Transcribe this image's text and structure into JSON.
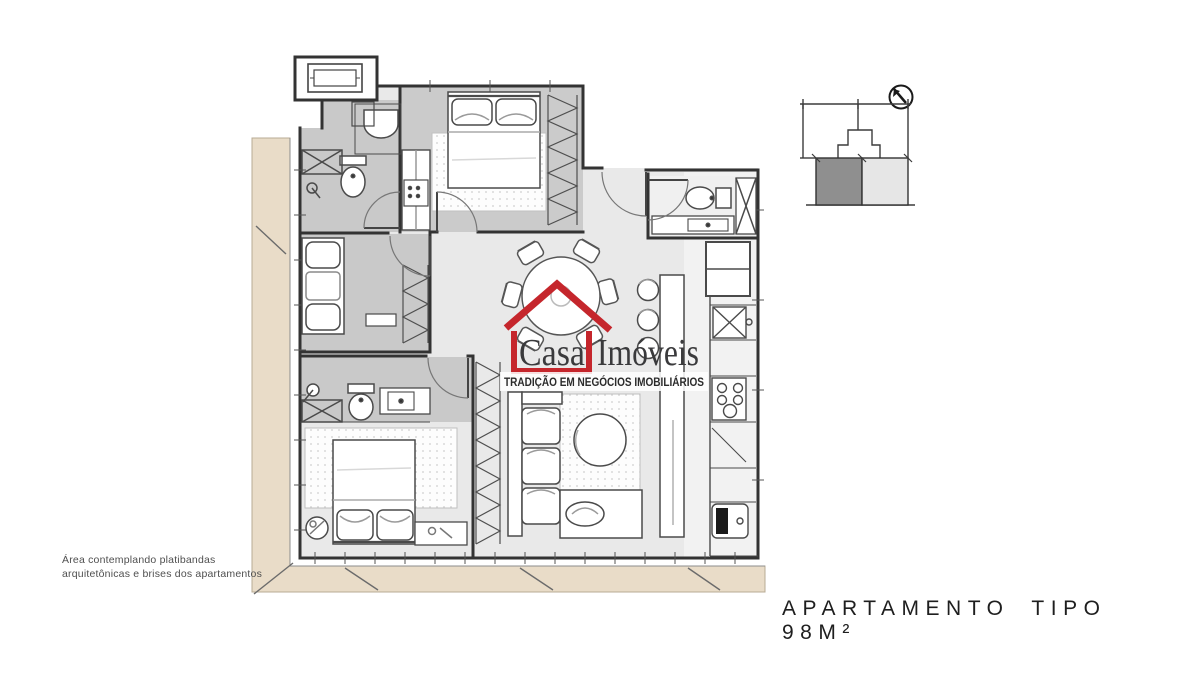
{
  "logo": {
    "word1": "Casa",
    "word2": "Imóveis",
    "tagline": "TRADIÇÃO EM NEGÓCIOS IMOBILIÁRIOS",
    "accent_color": "#c5262c",
    "text_color": "#3a3a3c"
  },
  "caption": {
    "text": "APARTAMENTO TIPO 98M²"
  },
  "note": {
    "line1": "Área contemplando platibandas",
    "line2": "arquitetônicas e brises dos apartamentos"
  },
  "key_plan": {
    "north_indicator": "north-arrow",
    "unit_highlight_color": "#8f8f8f",
    "unit_secondary_color": "#e6e6e6"
  },
  "plan": {
    "wall_color": "#333333",
    "room_shade_color": "#c9c9c9",
    "floor_color": "#e9e9e9",
    "platband_color": "#e9dcc8"
  }
}
